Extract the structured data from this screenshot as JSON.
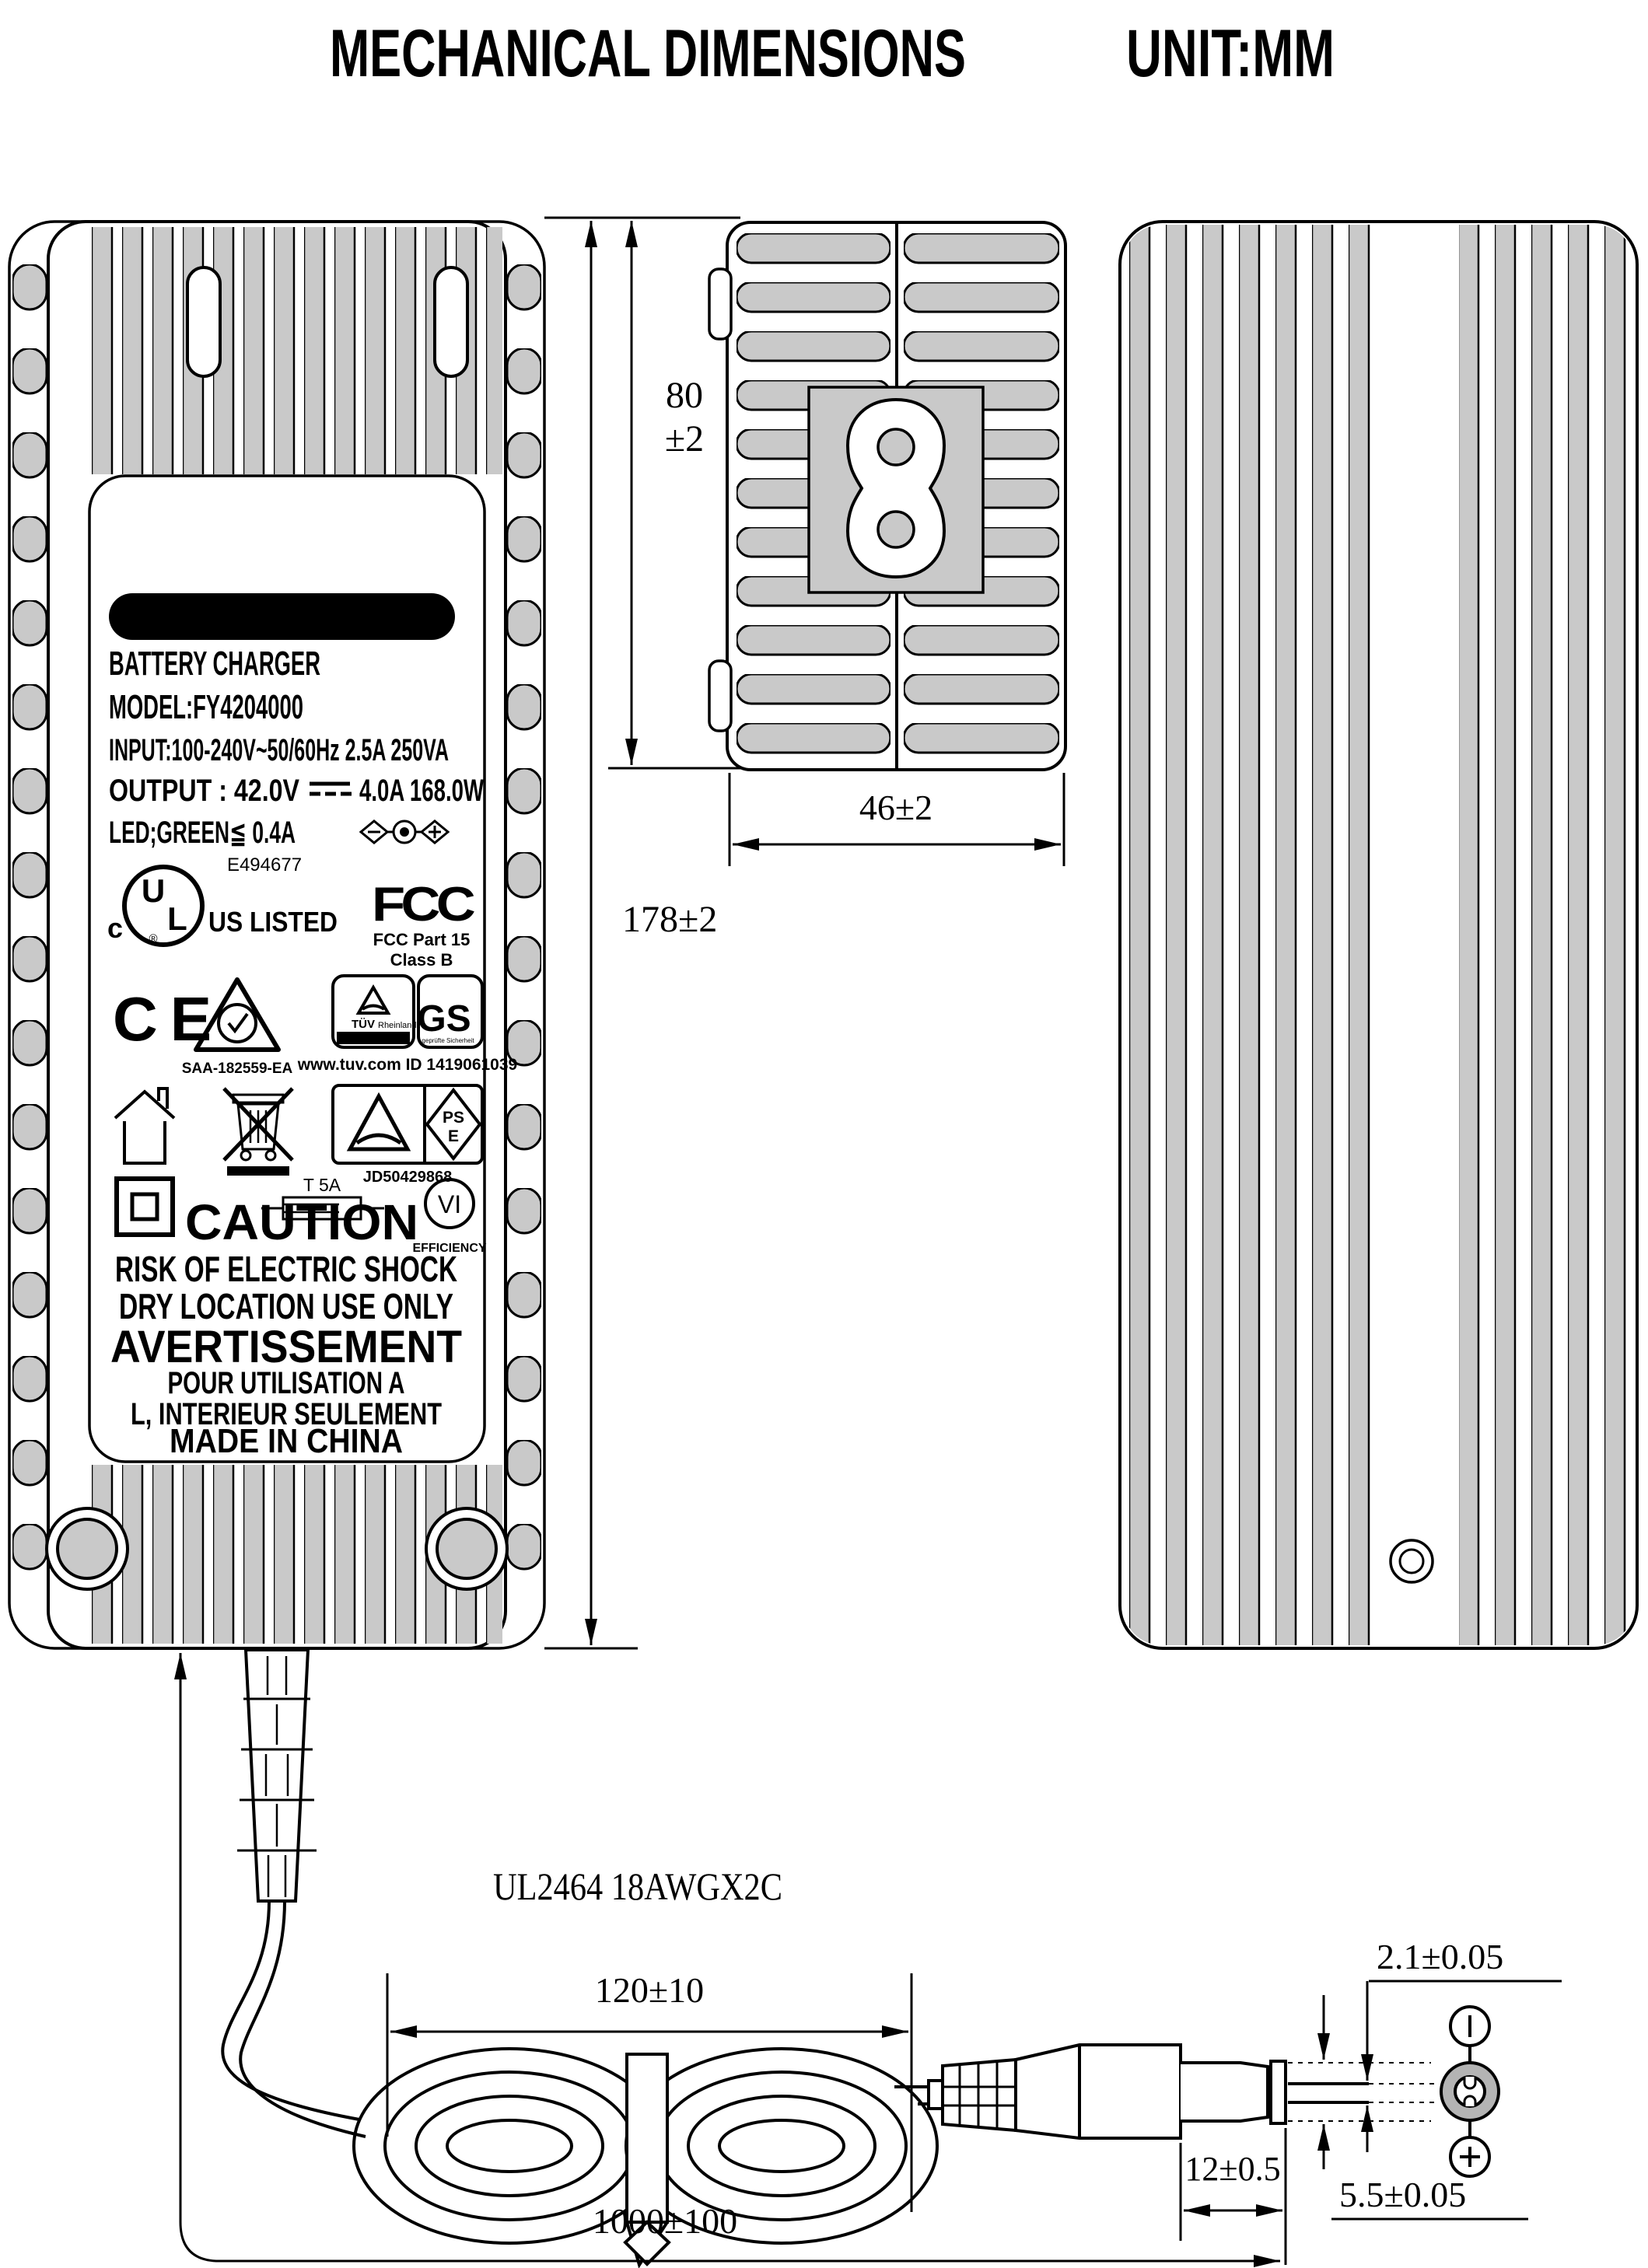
{
  "page": {
    "title": "MECHANICAL DIMENSIONS",
    "unit": "UNIT:MM"
  },
  "label": {
    "header": "FOR 36V LI-ION BATTERY",
    "product": "BATTERY CHARGER",
    "model": "MODEL:FY4204000",
    "input": "INPUT:100-240V~50/60Hz 2.5A 250VA",
    "output_left": "OUTPUT : 42.0V",
    "output_right": "4.0A  168.0W",
    "led": "LED;GREEN≦ 0.4A",
    "caution": "CAUTION",
    "warn1": "RISK OF ELECTRIC SHOCK",
    "warn2": "DRY LOCATION USE ONLY",
    "warn3": "AVERTISSEMENT",
    "warn4": "POUR UTILISATION A",
    "warn5": "L, INTERIEUR SEULEMENT",
    "origin": "MADE IN CHINA",
    "certs": {
      "ul_c": "c",
      "ul_u": "U",
      "ul_l": "L",
      "ul_reg": "®",
      "ul_us_listed": "US LISTED",
      "ul_file": "E494677",
      "fcc_logo": "FCC",
      "fcc_part": "FCC Part 15",
      "fcc_class": "Class B",
      "ce": "CE",
      "rcm_code": "SAA-182559-EA",
      "tuv_brand": "TÜV",
      "tuv_sub": "Rheinland",
      "tuv_band": "ZERTIFIZIERT",
      "gs": "GS",
      "gs_sub": "geprüfte Sicherheit",
      "tuv_id": "www.tuv.com  ID 1419061039",
      "pse_ps": "PS",
      "pse_e": "E",
      "pse_id": "JD50429868",
      "fuse": "T 5A",
      "eff_mark": "VI",
      "eff_label": "EFFICIENCY"
    }
  },
  "dimensions": {
    "height": "178±2",
    "depth_val": "80",
    "depth_tol": "±2",
    "width": "46±2",
    "coil_width": "120±10",
    "cable_length": "1000±100",
    "barrel_length": "12±0.5",
    "barrel_diameter": "5.5±0.05",
    "pin_diameter": "2.1±0.05",
    "cable_spec": "UL2464 18AWGX2C"
  },
  "colors": {
    "line": "#000000",
    "fin_gray": "#c9c9c9",
    "metal_gray": "#b4b4b4",
    "background": "#ffffff"
  }
}
